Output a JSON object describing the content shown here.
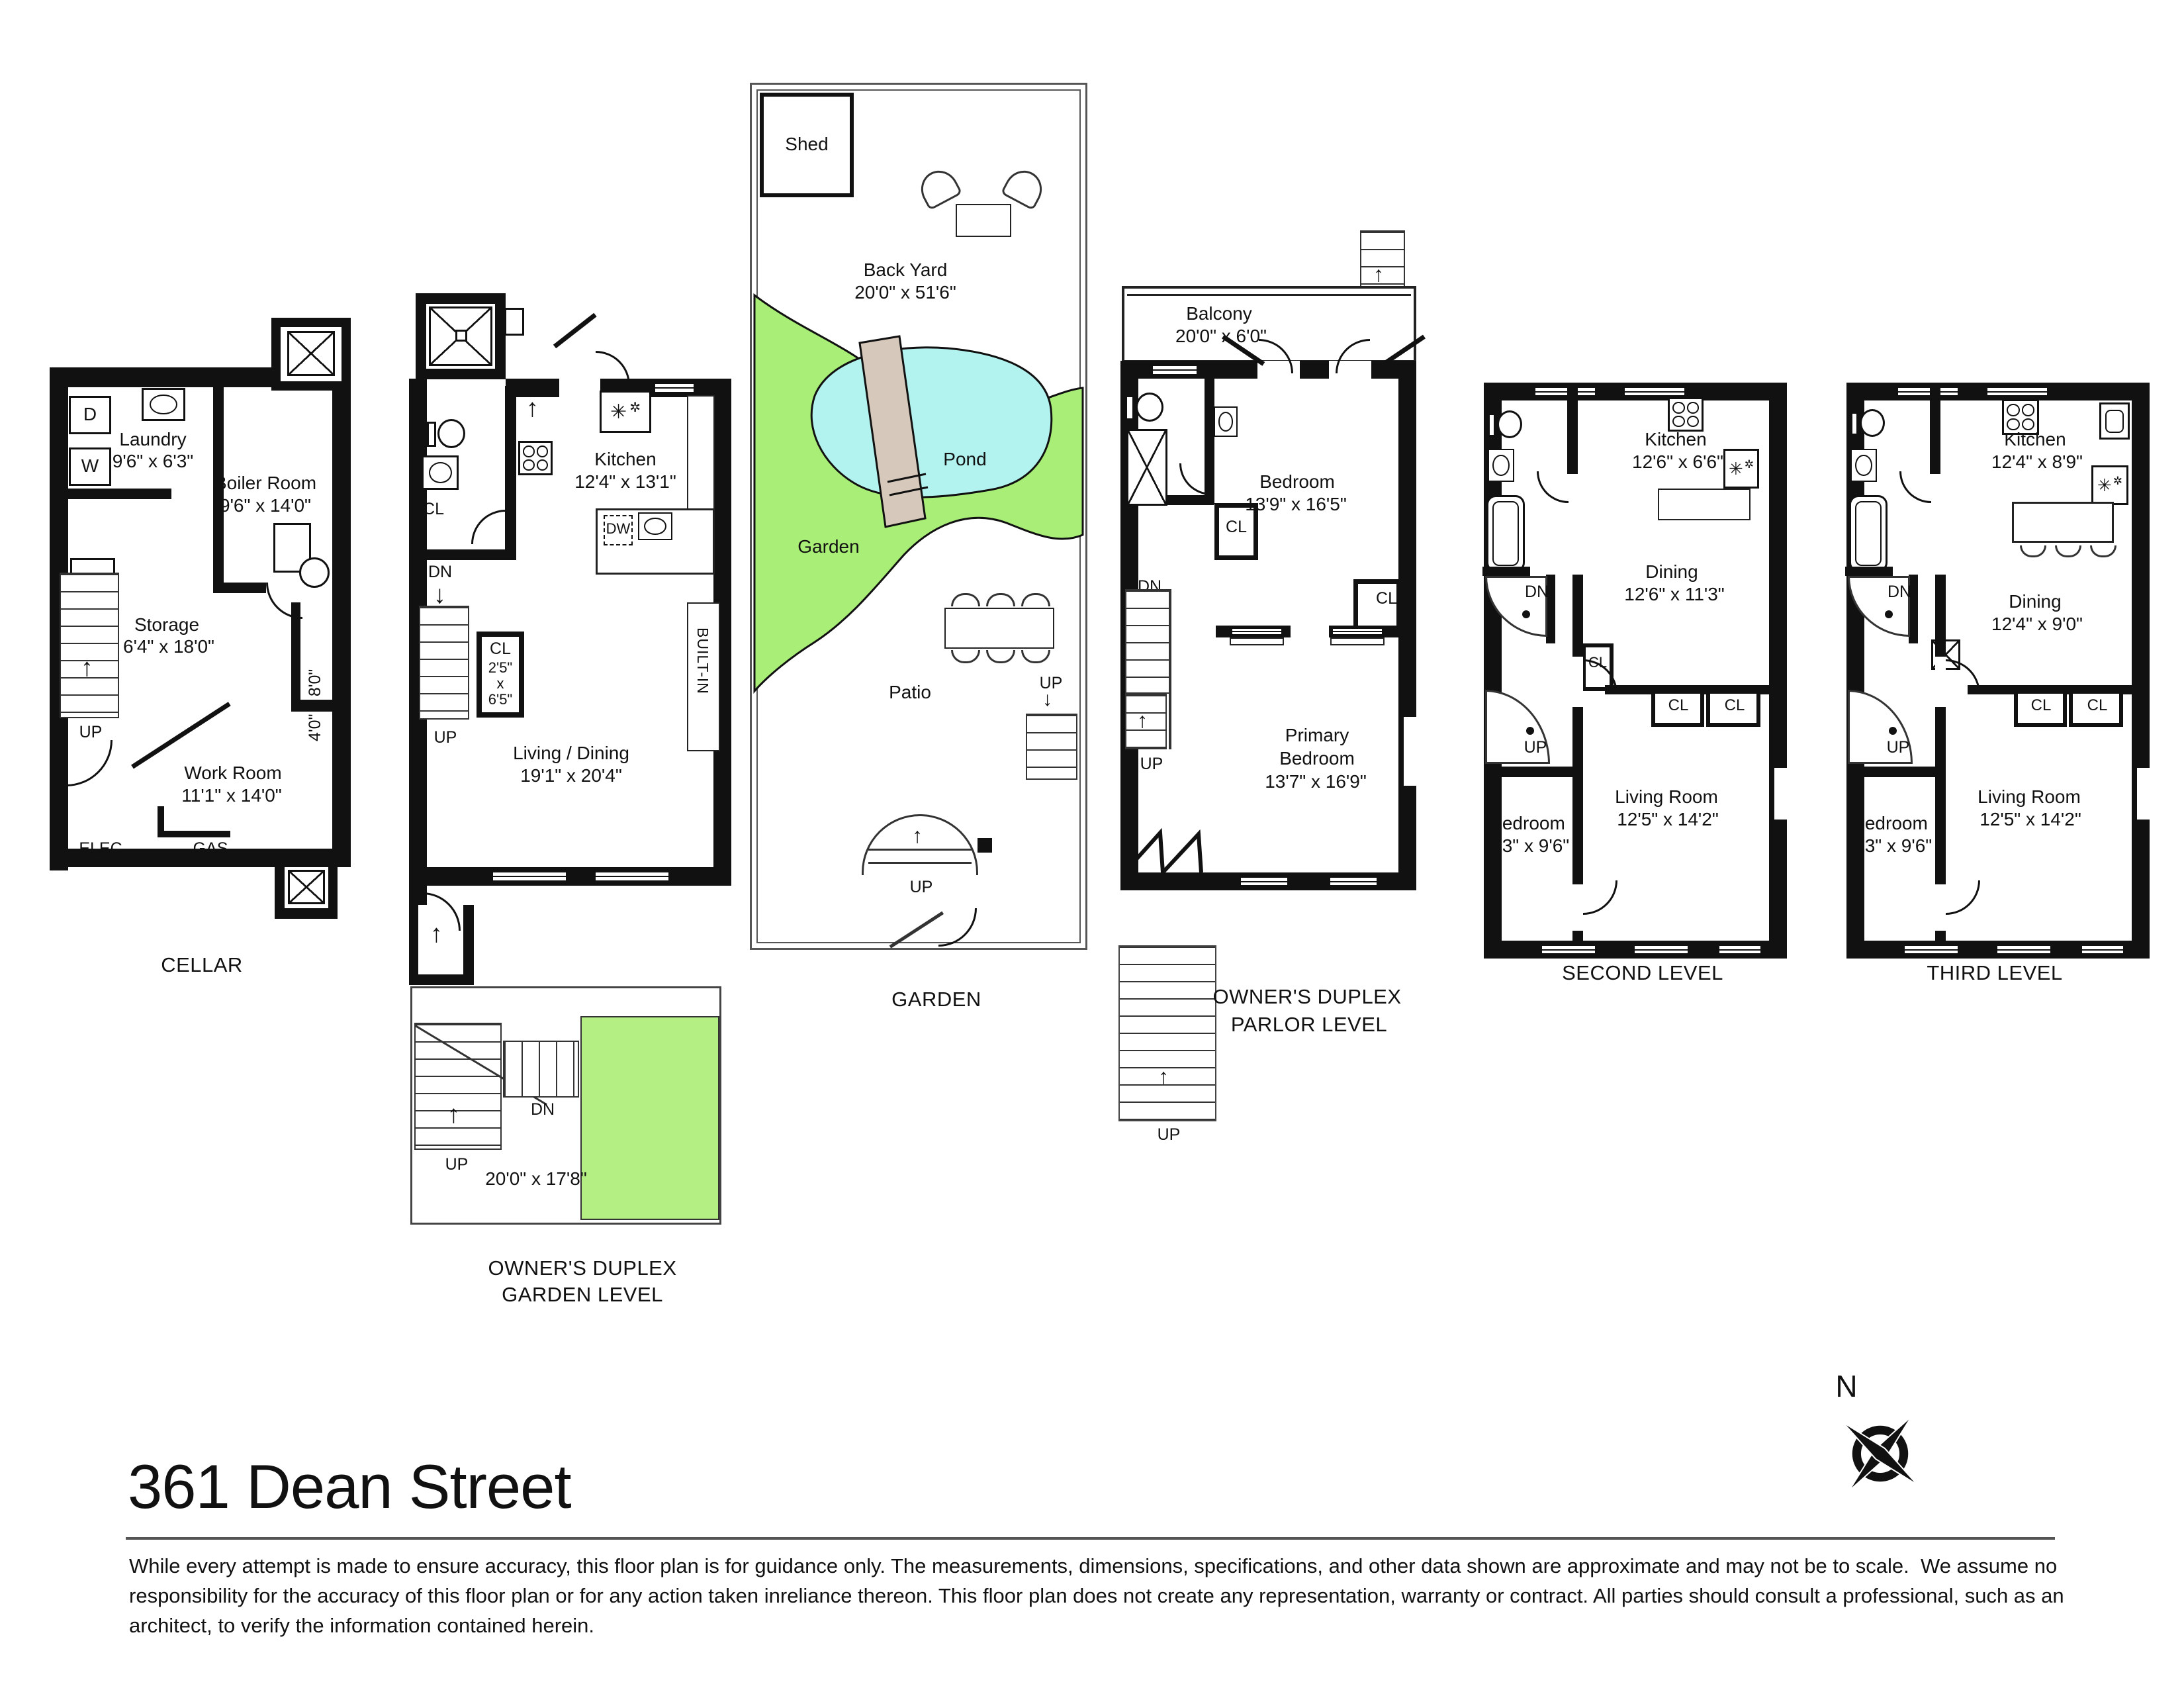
{
  "title": "361 Dean Street",
  "disclaimer": [
    "While every attempt is made to ensure accuracy, this floor plan is for guidance only. The measurements, dimensions, specifications, and other data shown are approximate and may not be to scale.  We assume no",
    "responsibility for the accuracy of this floor plan or for any action taken inreliance thereon. This floor plan does not create any representation, warranty or contract. All parties should consult a professional, such as an",
    "architect, to verify the information contained herein."
  ],
  "compass": {
    "north": "N"
  },
  "icons": {
    "snowflake_big": "✳",
    "snowflake_small": "✲",
    "arrow_up": "↑",
    "arrow_down": "↓"
  },
  "common": {
    "up": "UP",
    "dn": "DN",
    "cl": "CL",
    "d": "D",
    "w": "W",
    "hvac": "HVAC",
    "elec": "ELEC",
    "gas": "GAS",
    "dw": "DW",
    "builtin": "BUILT-IN"
  },
  "colors": {
    "grass": "#a9ee77",
    "pond": "#b2f3f0",
    "bridge": "#d6c8ba",
    "lawn": "#b4ef83"
  },
  "plans": {
    "cellar": {
      "title": "CELLAR",
      "laundry": {
        "name": "Laundry",
        "dims": "9'6\" x 6'3\""
      },
      "boiler": {
        "name": "Boiler Room",
        "dims": "9'6\" x 14'0\""
      },
      "storage": {
        "name": "Storage",
        "dims": "6'4\" x 18'0\""
      },
      "work": {
        "name": "Work Room",
        "dims": "11'1\" x 14'0\""
      },
      "crawl_dims": "4'0\" x 8'0\""
    },
    "garden_level": {
      "title1": "OWNER'S DUPLEX",
      "title2": "GARDEN LEVEL",
      "kitchen": {
        "name": "Kitchen",
        "dims": "12'4\" x 13'1\""
      },
      "living": {
        "name": "Living / Dining",
        "dims": "19'1\" x 20'4\""
      },
      "closet": {
        "l1": "CL",
        "l2": "2'5\"",
        "l3": "x",
        "l4": "6'5\""
      },
      "deck_dims": "20'0\" x 17'8\""
    },
    "garden": {
      "title": "GARDEN",
      "shed": "Shed",
      "backyard": {
        "name": "Back Yard",
        "dims": "20'0\" x 51'6\""
      },
      "pond": "Pond",
      "garden": "Garden",
      "patio": "Patio"
    },
    "parlor": {
      "title1": "OWNER'S DUPLEX",
      "title2": "PARLOR LEVEL",
      "balcony": {
        "name": "Balcony",
        "dims": "20'0\" x 6'0\""
      },
      "bedroom": {
        "name": "Bedroom",
        "dims": "13'9\" x 16'5\""
      },
      "primary": {
        "l1": "Primary",
        "l2": "Bedroom",
        "dims": "13'7\" x 16'9\""
      }
    },
    "second": {
      "title": "SECOND LEVEL",
      "kitchen": {
        "name": "Kitchen",
        "dims": "12'6\" x 6'6\""
      },
      "dining": {
        "name": "Dining",
        "dims": "12'6\" x 11'3\""
      },
      "living": {
        "name": "Living Room",
        "dims": "12'5\" x 14'2\""
      },
      "bedroom": {
        "name": "Bedroom",
        "dims": "6'3\" x 9'6\""
      }
    },
    "third": {
      "title": "THIRD LEVEL",
      "kitchen": {
        "name": "Kitchen",
        "dims": "12'4\" x 8'9\""
      },
      "dining": {
        "name": "Dining",
        "dims": "12'4\" x 9'0\""
      },
      "living": {
        "name": "Living Room",
        "dims": "12'5\" x 14'2\""
      },
      "bedroom": {
        "name": "Bedroom",
        "dims": "6'3\" x 9'6\""
      }
    }
  }
}
